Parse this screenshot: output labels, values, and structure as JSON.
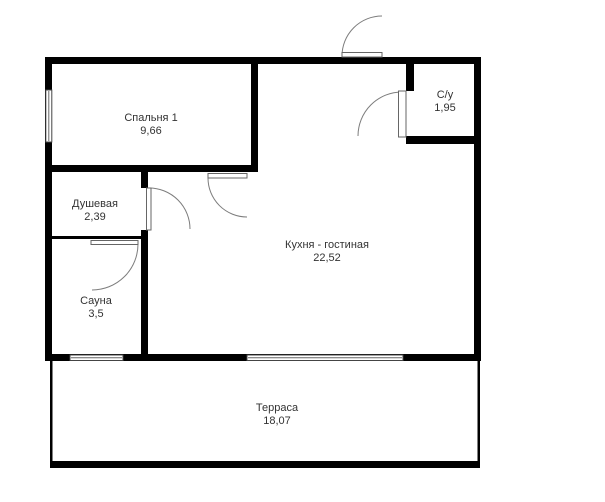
{
  "plan": {
    "background_color": "#ffffff",
    "wall_color": "#000000",
    "door_arc_color": "#7d7d7d",
    "text_color": "#333333",
    "rooms": [
      {
        "name": "Спальня 1",
        "area": "9,66"
      },
      {
        "name": "С/у",
        "area": "1,95"
      },
      {
        "name": "Душевая",
        "area": "2,39"
      },
      {
        "name": "Кухня - гостиная",
        "area": "22,52"
      },
      {
        "name": "Сауна",
        "area": "3,5"
      },
      {
        "name": "Терраса",
        "area": "18,07"
      }
    ]
  }
}
